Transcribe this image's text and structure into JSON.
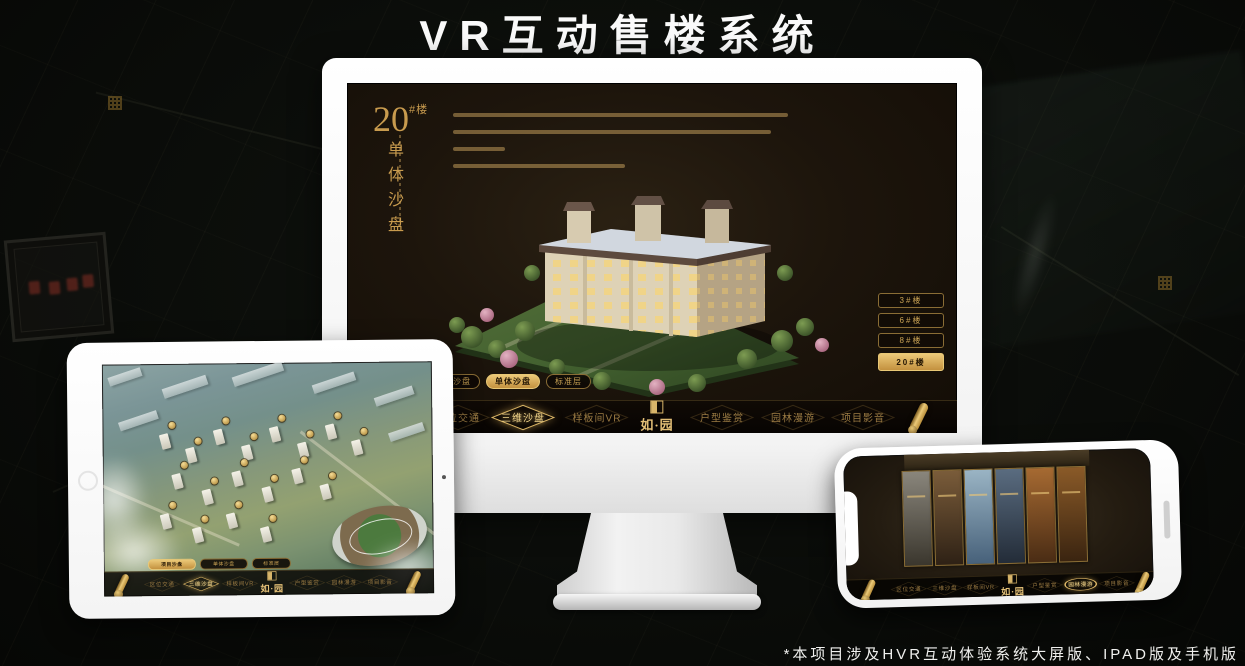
{
  "title": "VR互动售楼系统",
  "footnote": "*本项目涉及HVR互动体验系统大屏版、IPAD版及手机版",
  "brand": {
    "logo": "如·园",
    "accent_gold": "#c9a254"
  },
  "menus": {
    "tabs": [
      "项目沙盘",
      "单体沙盘",
      "标准层"
    ],
    "nav": [
      "区位交通",
      "三维沙盘",
      "样板间VR",
      "户型鉴赏",
      "园林漫游",
      "项目影音"
    ]
  },
  "monitor": {
    "unit_number": "20",
    "unit_suffix": "#楼",
    "unit_title_vertical": "单体沙盘",
    "floor_buttons": [
      "3#楼",
      "6#楼",
      "8#楼",
      "20#楼"
    ],
    "active_floor": "20#楼",
    "active_tab": "单体沙盘",
    "active_nav": "三维沙盘"
  },
  "tablet": {
    "active_tab": "项目沙盘",
    "active_nav": "三维沙盘"
  },
  "phone": {
    "active_nav": "园林漫游"
  }
}
